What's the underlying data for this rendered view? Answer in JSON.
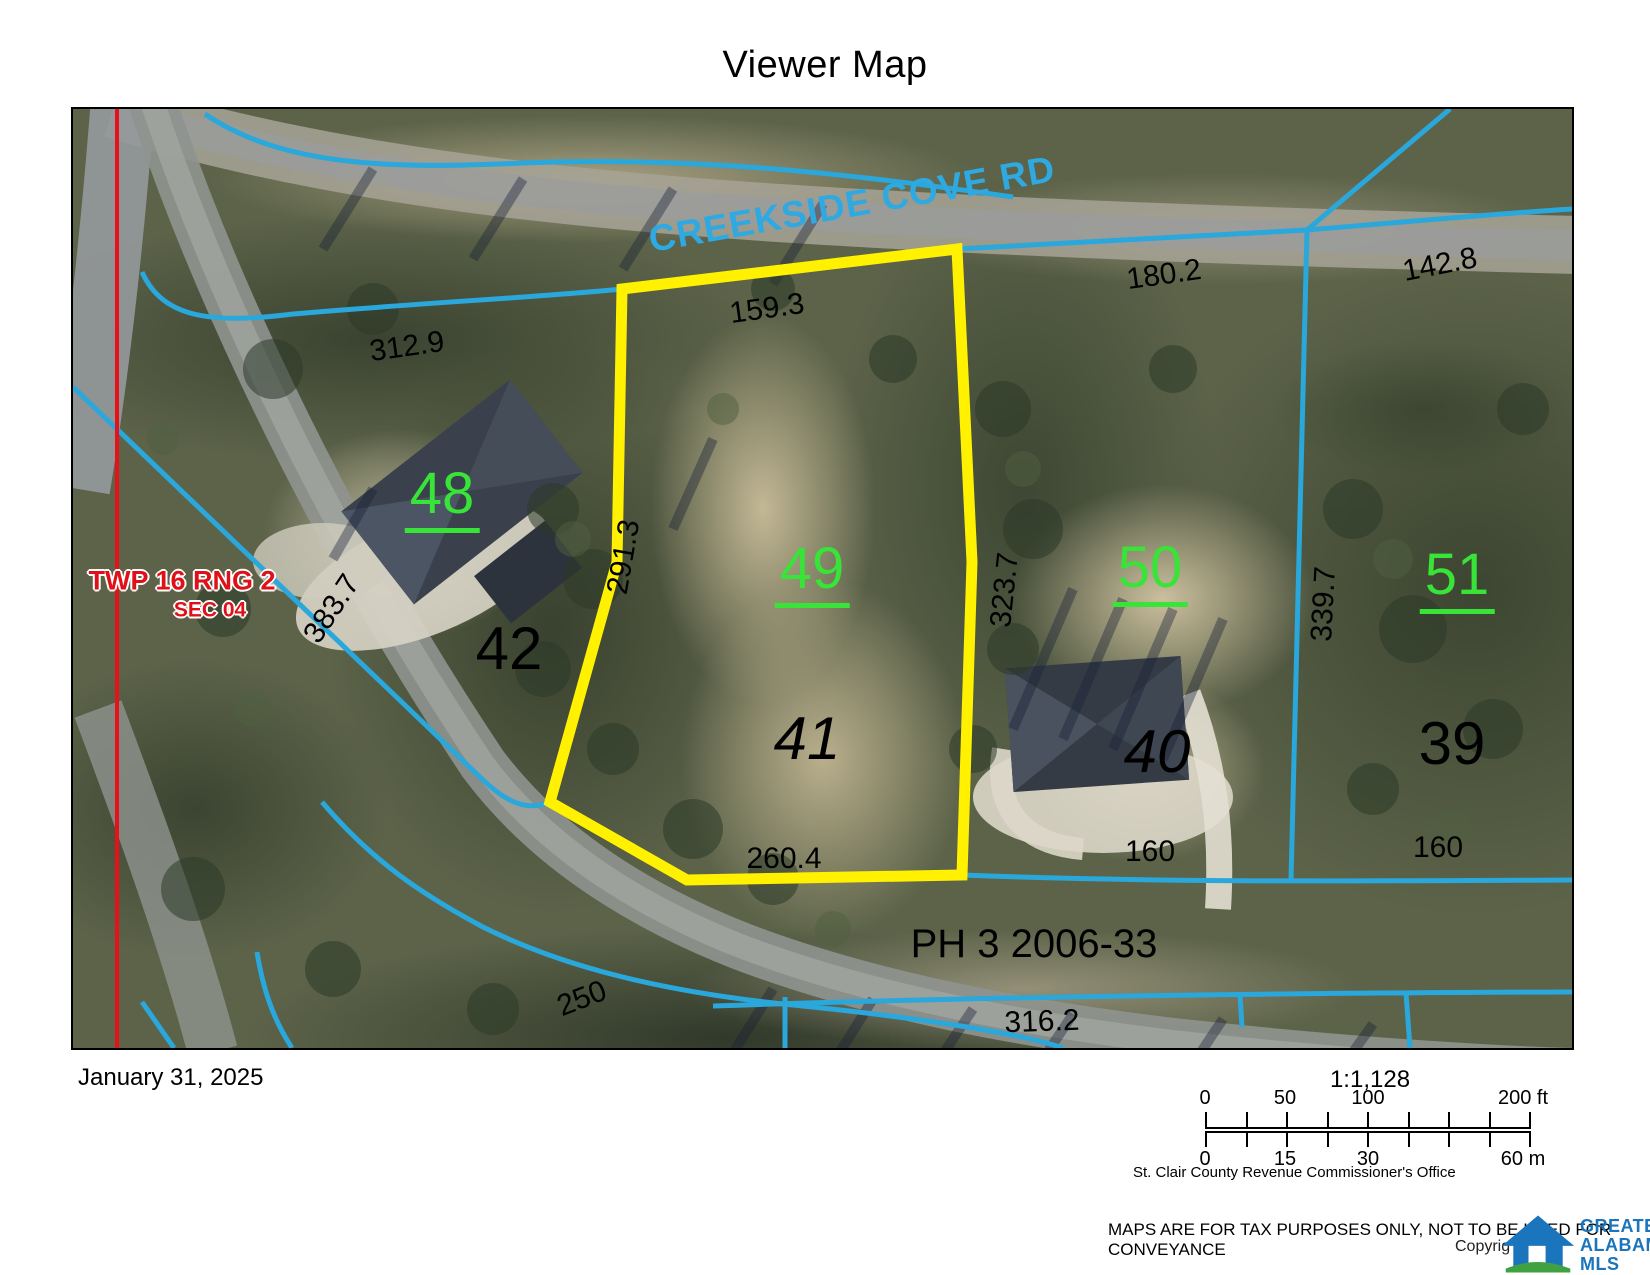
{
  "title": "Viewer Map",
  "map": {
    "road_label": "CREEKSIDE COVE RD",
    "township_line1": "TWP 16  RNG 2",
    "township_line2": "SEC 04",
    "phase_label": "PH 3 2006-33",
    "highlight_color": "#fff100",
    "boundary_color": "#2aa7db",
    "section_line_color": "#e8111a",
    "lot_number_green_color": "#37e437",
    "lot_numbers": {
      "green": [
        "48",
        "49",
        "50",
        "51"
      ],
      "black": [
        "42",
        "41",
        "40",
        "39"
      ]
    },
    "dimensions": [
      "312.9",
      "159.3",
      "180.2",
      "142.8",
      "291.3",
      "323.7",
      "339.7",
      "383.7",
      "260.4",
      "160",
      "160",
      "250",
      "316.2"
    ]
  },
  "footer": {
    "date": "January 31, 2025",
    "scale_ratio": "1:1,128",
    "feet_ticks": [
      "0",
      "50",
      "100",
      "200 ft"
    ],
    "meter_ticks": [
      "0",
      "15",
      "30",
      "60 m"
    ],
    "source": "St. Clair County Revenue Commissioner's Office",
    "disclaimer": "MAPS ARE FOR TAX PURPOSES ONLY, NOT TO BE USED FOR CONVEYANCE",
    "copyright": "Copyrig",
    "logo": [
      "GREATER",
      "ALABAMA",
      "MLS"
    ]
  }
}
